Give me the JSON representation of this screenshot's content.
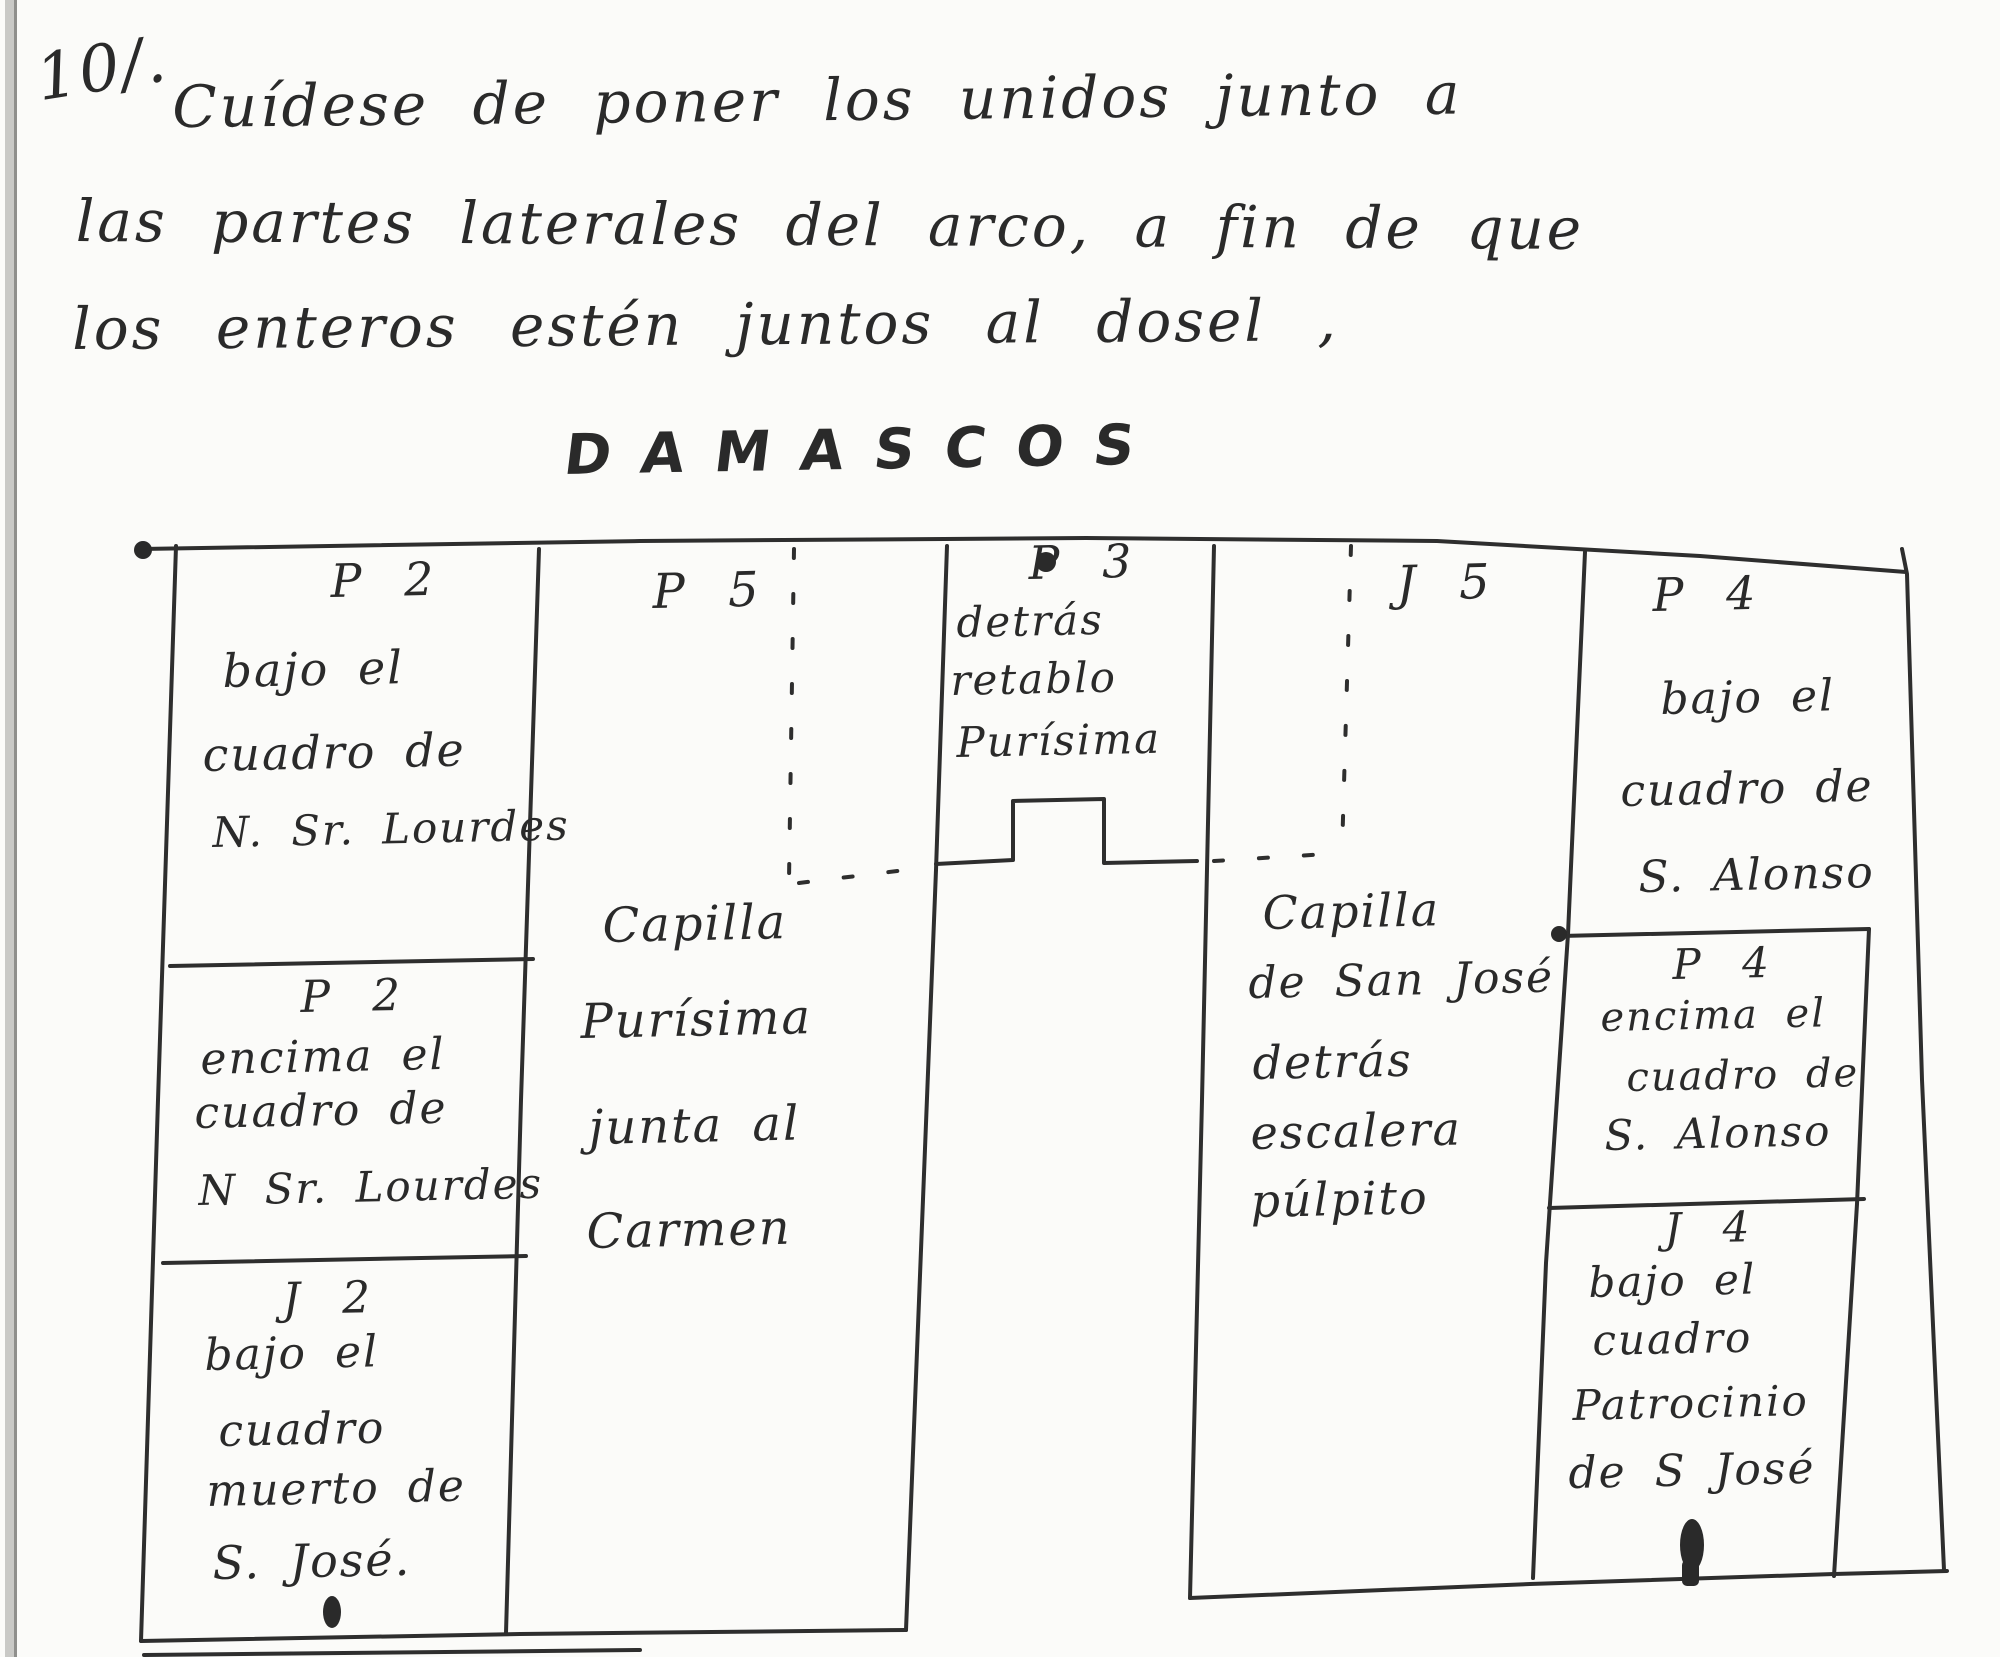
{
  "note": {
    "number": "10/.",
    "line1": "Cuídese de poner los unidos junto a",
    "line2": "las partes laterales del arco, a fin de que",
    "line3": "los enteros estén juntos al dosel ,",
    "title": "DAMASCOS"
  },
  "plan": {
    "left_boxes": [
      {
        "code": "P 2",
        "lines": [
          "bajo el",
          "cuadro de",
          "N. Sr. Lourdes"
        ]
      },
      {
        "code": "P 2",
        "lines": [
          "encima el",
          "cuadro de",
          "N Sr. Lourdes"
        ]
      },
      {
        "code": "J 2",
        "lines": [
          "bajo el",
          "cuadro",
          "muerto de",
          "S. José."
        ]
      }
    ],
    "left_chapel": {
      "code": "P 5",
      "lines": [
        "Capilla",
        "Purísima",
        "junta al",
        "Carmen"
      ]
    },
    "center_box": {
      "code": "P 3",
      "lines": [
        "detrás",
        "retablo",
        "Purísima"
      ]
    },
    "right_chapel": {
      "code": "J 5",
      "lines": [
        "Capilla",
        "de San José",
        "detrás",
        "escalera",
        "púlpito"
      ]
    },
    "right_boxes": [
      {
        "code": "P 4",
        "lines": [
          "bajo el",
          "cuadro de",
          "S. Alonso"
        ]
      },
      {
        "code": "P 4",
        "lines": [
          "encima el",
          "cuadro de",
          "S. Alonso"
        ]
      },
      {
        "code": "J 4",
        "lines": [
          "bajo el",
          "cuadro",
          "Patrocinio",
          "de S José"
        ]
      }
    ]
  },
  "ink_color": "#2e2e2e"
}
